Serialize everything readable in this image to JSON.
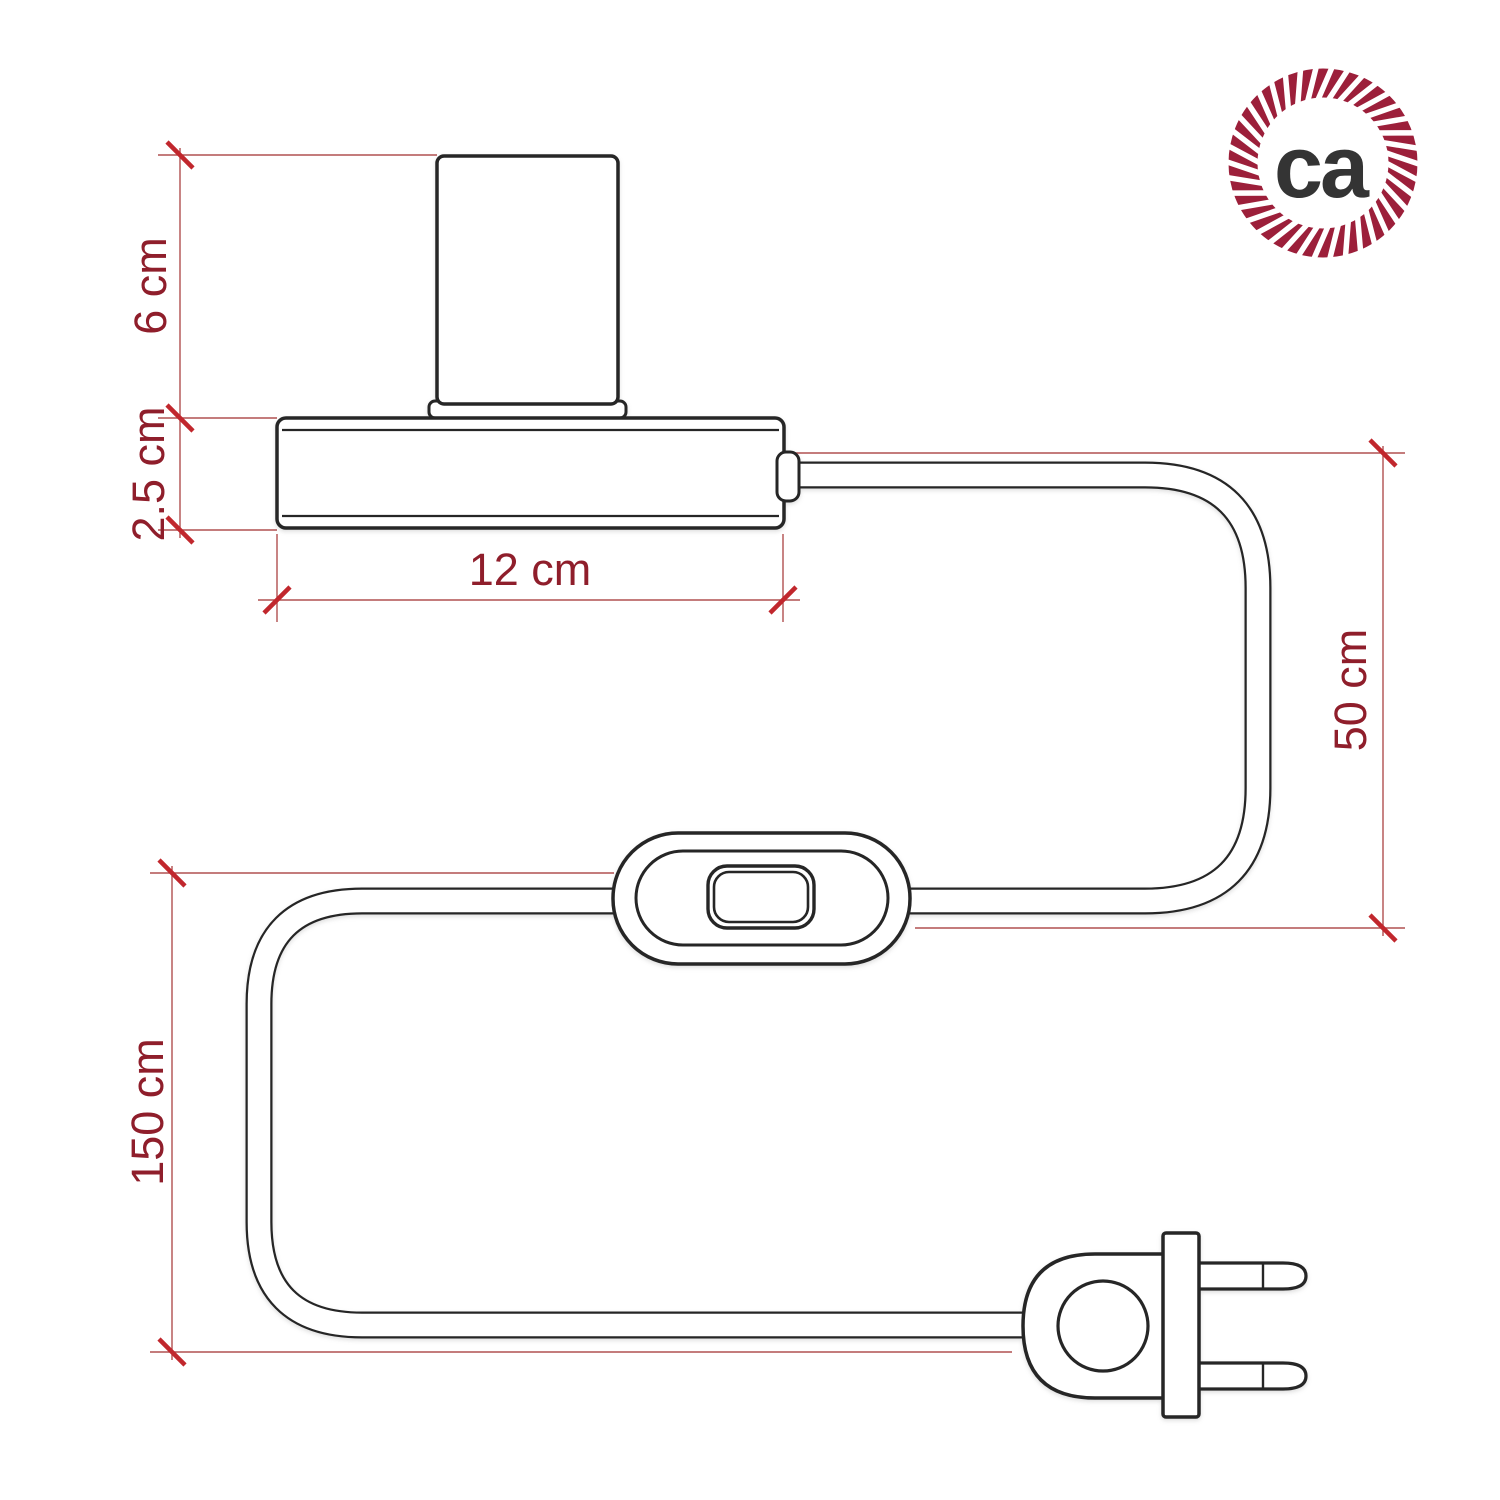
{
  "diagram": {
    "title": "table lamp with inline switch and two-prong plug - dimension drawing",
    "dimensions": {
      "socket_height": "6 cm",
      "base_height": "2.5 cm",
      "base_width": "12 cm",
      "cable_lamp_to_switch": "50 cm",
      "cable_switch_to_plug": "150 cm"
    },
    "parts": {
      "socket": "lamp-socket-cylinder",
      "base": "lamp-base",
      "cable": "power-cable",
      "switch": "inline-rocker-switch",
      "plug": "two-prong-plug"
    }
  },
  "logo": {
    "text": "ca",
    "rope_color": "#9c1f3a",
    "text_color": "#343434",
    "strand_color": "#ffffff"
  },
  "colors": {
    "background": "#ffffff",
    "outline": "#262626",
    "dimension_line": "#b05050",
    "tick": "#c1272d",
    "label": "#8f1e2b"
  }
}
